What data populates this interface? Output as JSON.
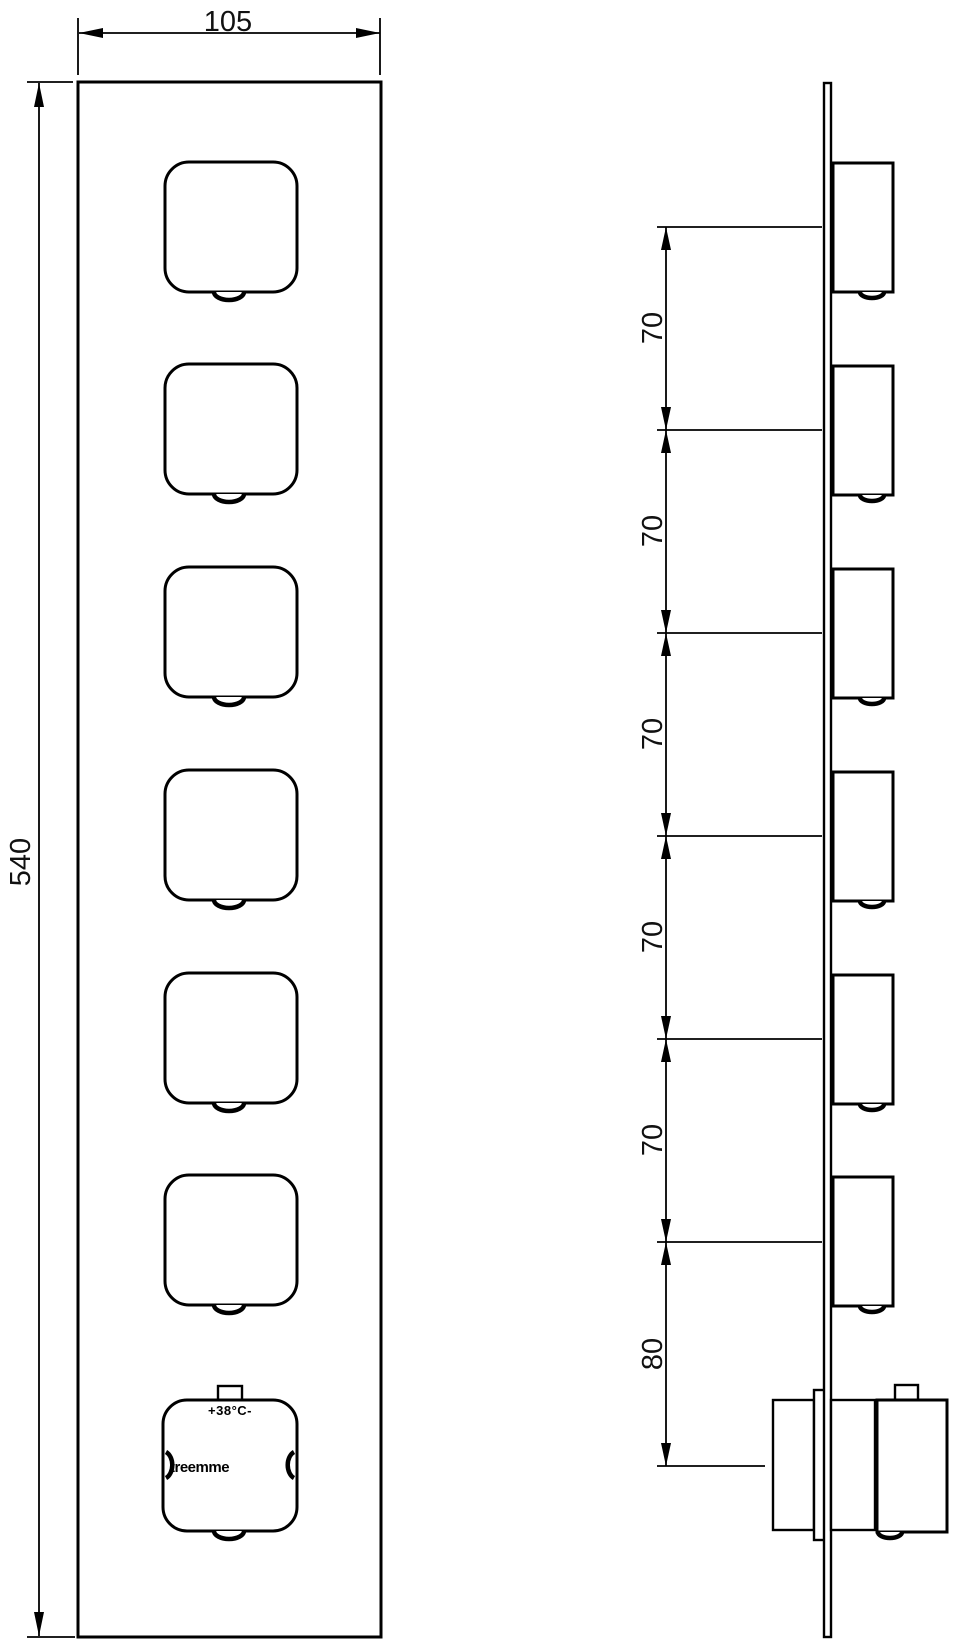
{
  "front_view": {
    "width_dim": "105",
    "height_dim": "540",
    "thermostat_knob": {
      "temperature_label": "+38°C-",
      "brand_label": "treemme"
    }
  },
  "side_view": {
    "spacing_dims": [
      "70",
      "70",
      "70",
      "70",
      "70",
      "80"
    ]
  },
  "colors": {
    "line": "#000000",
    "background": "#ffffff"
  }
}
